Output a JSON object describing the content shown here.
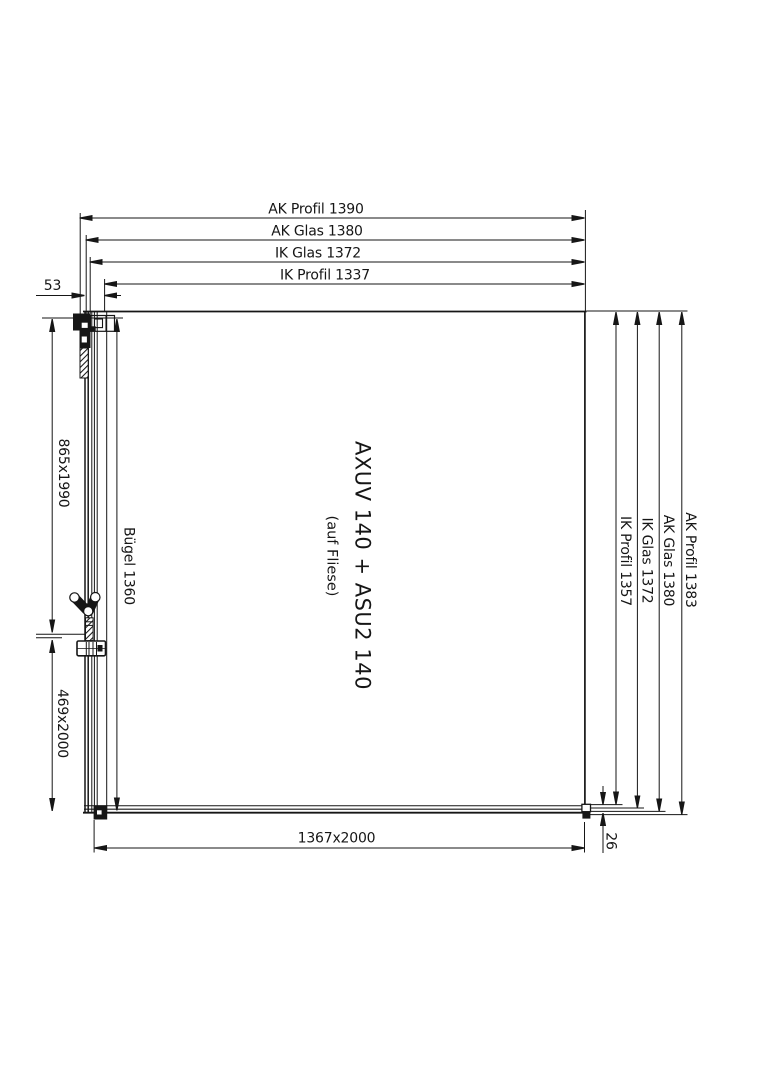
{
  "colors": {
    "line": "#161616",
    "background": "#ffffff"
  },
  "product": {
    "title": "AXUV 140 + ASU2 140",
    "subtitle": "(auf Fliese)"
  },
  "dims": {
    "top": [
      "AK Profil 1390",
      "AK Glas 1380",
      "IK Glas 1372",
      "IK Profil 1337"
    ],
    "offset53": "53",
    "left": {
      "door_glass": "865x1990",
      "buegel": "Bügel 1360",
      "side_glass": "469x2000"
    },
    "right": [
      "IK Profil 1357",
      "IK Glas 1372",
      "AK Glas 1380",
      "AK Profil 1383"
    ],
    "bottom": {
      "main": "1367x2000",
      "offset26": "26"
    }
  }
}
